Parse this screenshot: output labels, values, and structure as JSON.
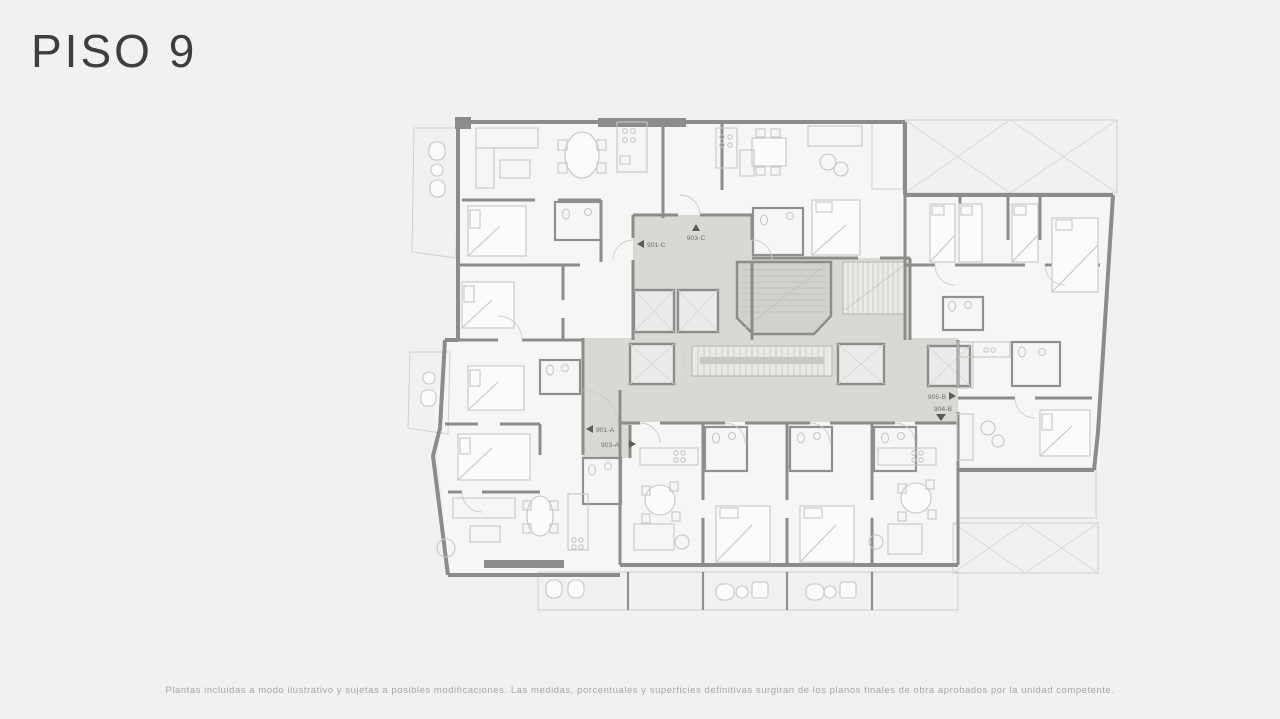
{
  "page": {
    "title": "PISO 9",
    "footer": "Plantas incluidas a modo ilustrativo y sujetas a posibles modificaciones. Las medidas, porcentuales y superficies definitivas surgiran de los planos finales de obra aprobados por la unidad competente.",
    "background": "#f1f1ef"
  },
  "floorplan": {
    "floor_label": "PISO 9",
    "units": [
      {
        "id": "901-C",
        "arrow": "left"
      },
      {
        "id": "903-C",
        "arrow": "up"
      },
      {
        "id": "901-A",
        "arrow": "left"
      },
      {
        "id": "903-A",
        "arrow": "right"
      },
      {
        "id": "905-B",
        "arrow": "right"
      },
      {
        "id": "904-B",
        "arrow": "down"
      }
    ],
    "colors": {
      "walls": "#8c8c8a",
      "circulation": "#d8d8d5",
      "floor": "#f6f6f4",
      "furniture": "#c6c6c4",
      "labels": "#6f6f6d"
    }
  }
}
